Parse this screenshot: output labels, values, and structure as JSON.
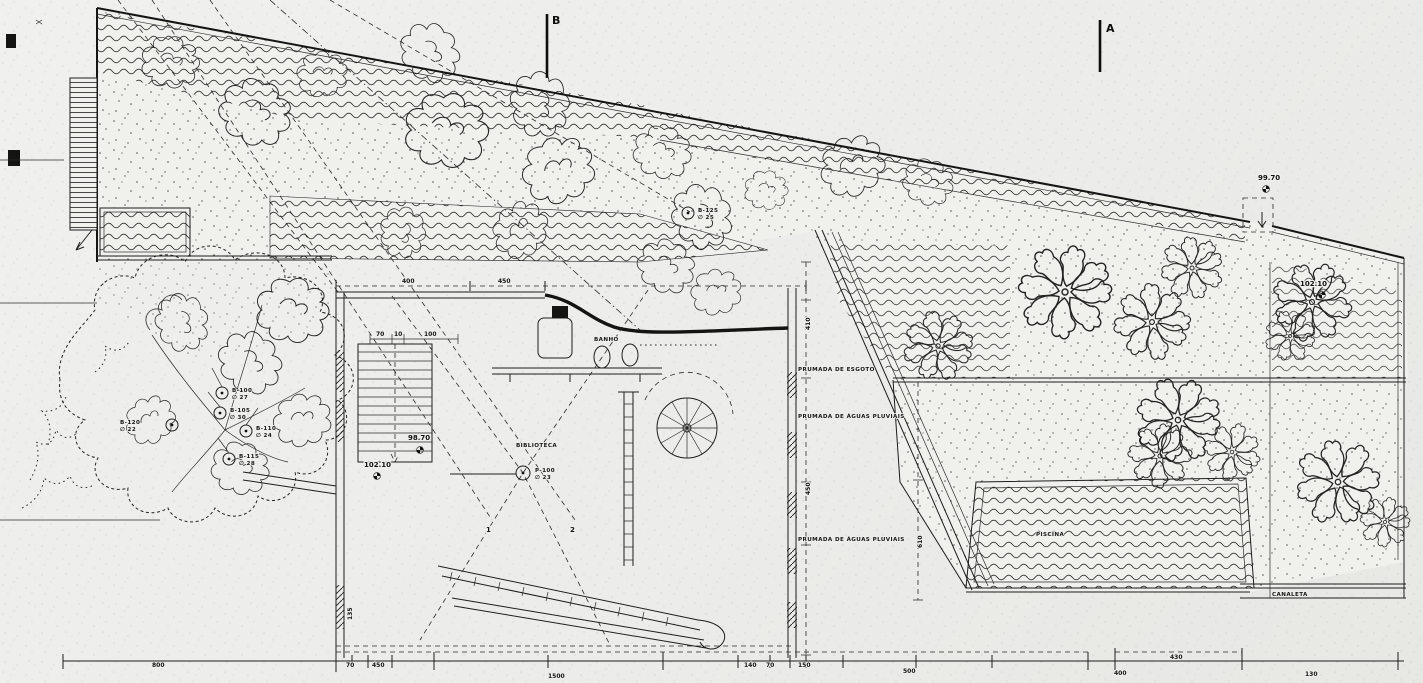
{
  "sections": {
    "b": "B",
    "a": "A"
  },
  "rooms": {
    "banho": "BANHO",
    "biblioteca": "BIBLIOTECA",
    "piscina": "PISCINA",
    "canaleta": "CANALETA"
  },
  "risers": {
    "esgoto": "PRUMADA DE ESGOTO",
    "pluviais_upper": "PRUMADA DE ÁGUAS PLUVIAIS",
    "pluviais_lower": "PRUMADA DE ÁGUAS PLUVIAIS"
  },
  "levels": {
    "roof_edge": "99.70",
    "terrace": "102.10",
    "stair_landing": "98.70",
    "court": "102.10"
  },
  "section_points": {
    "p1": "1",
    "p2": "2"
  },
  "tree_tags": [
    {
      "id": "B-100",
      "diameter": "∅ 27"
    },
    {
      "id": "B-105",
      "diameter": "∅ 30"
    },
    {
      "id": "B-110",
      "diameter": "∅ 24"
    },
    {
      "id": "B-115",
      "diameter": "∅ 28"
    },
    {
      "id": "B-120",
      "diameter": "∅ 22"
    },
    {
      "id": "B-125",
      "diameter": "∅ 25"
    },
    {
      "id": "P-100",
      "diameter": "∅ 23"
    }
  ],
  "dimensions": {
    "bottom": [
      "800",
      "70",
      "450",
      "1500",
      "140",
      "70",
      "150",
      "500",
      "430",
      "400",
      "130"
    ],
    "inner_top": [
      "400",
      "450"
    ],
    "inner_small": [
      "70",
      "10",
      "100"
    ],
    "vertical": [
      "410",
      "450",
      "610",
      "135"
    ]
  }
}
